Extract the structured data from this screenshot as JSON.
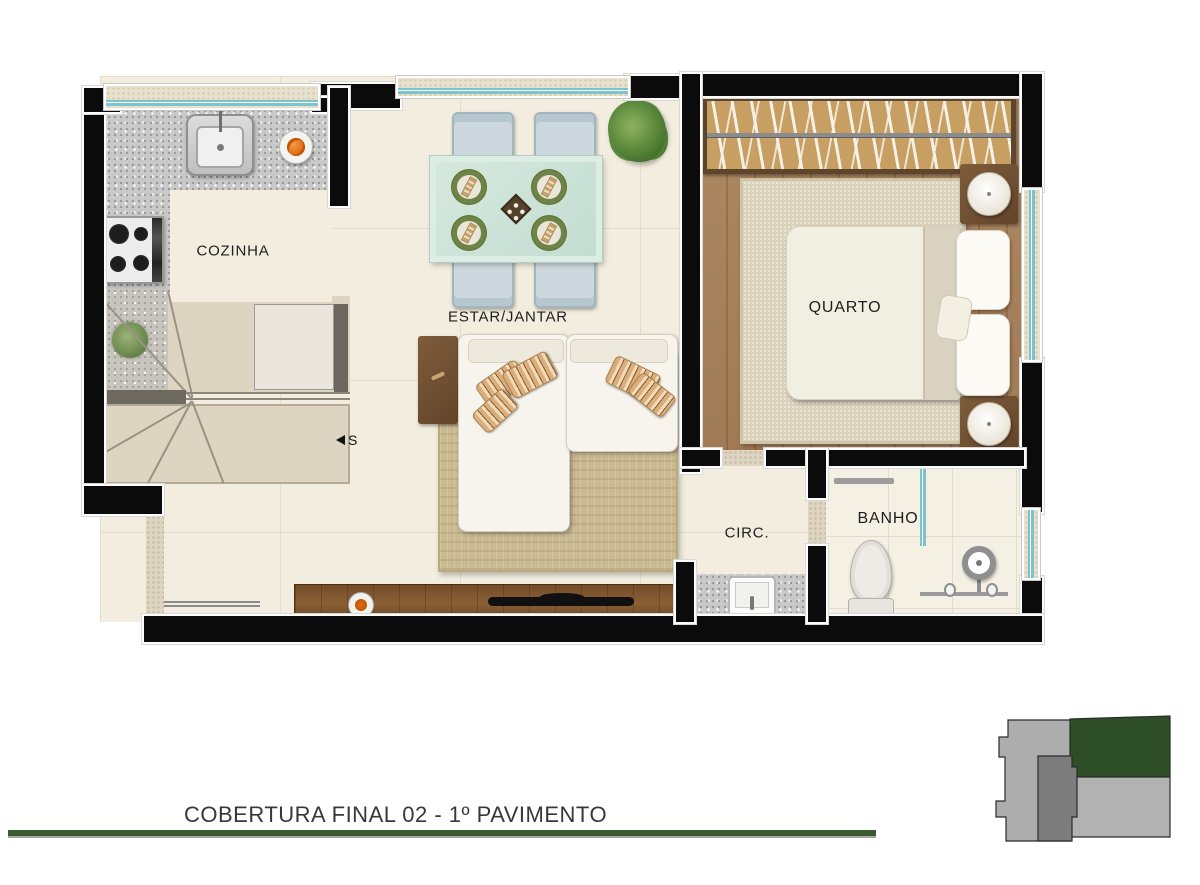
{
  "title": "COBERTURA FINAL 02 - 1º PAVIMENTO",
  "rooms": {
    "cozinha": {
      "label": "COZINHA"
    },
    "estar_jantar": {
      "label": "ESTAR/JANTAR"
    },
    "quarto": {
      "label": "QUARTO"
    },
    "circ": {
      "label": "CIRC."
    },
    "banho": {
      "label": "BANHO"
    }
  },
  "stairs": {
    "marker": "S"
  },
  "colors": {
    "wall": "#0b0b0b",
    "window_glass": "#7cc4cd",
    "floor_cream": "#f2edde",
    "wood_floor": "#a9825a",
    "caption_line_green": "#3a5a31",
    "key_highlight_green": "#2e4e27",
    "key_light_gray": "#adadad",
    "key_mid_gray": "#b2b2b2",
    "key_dark_gray": "#7c7c7c"
  }
}
